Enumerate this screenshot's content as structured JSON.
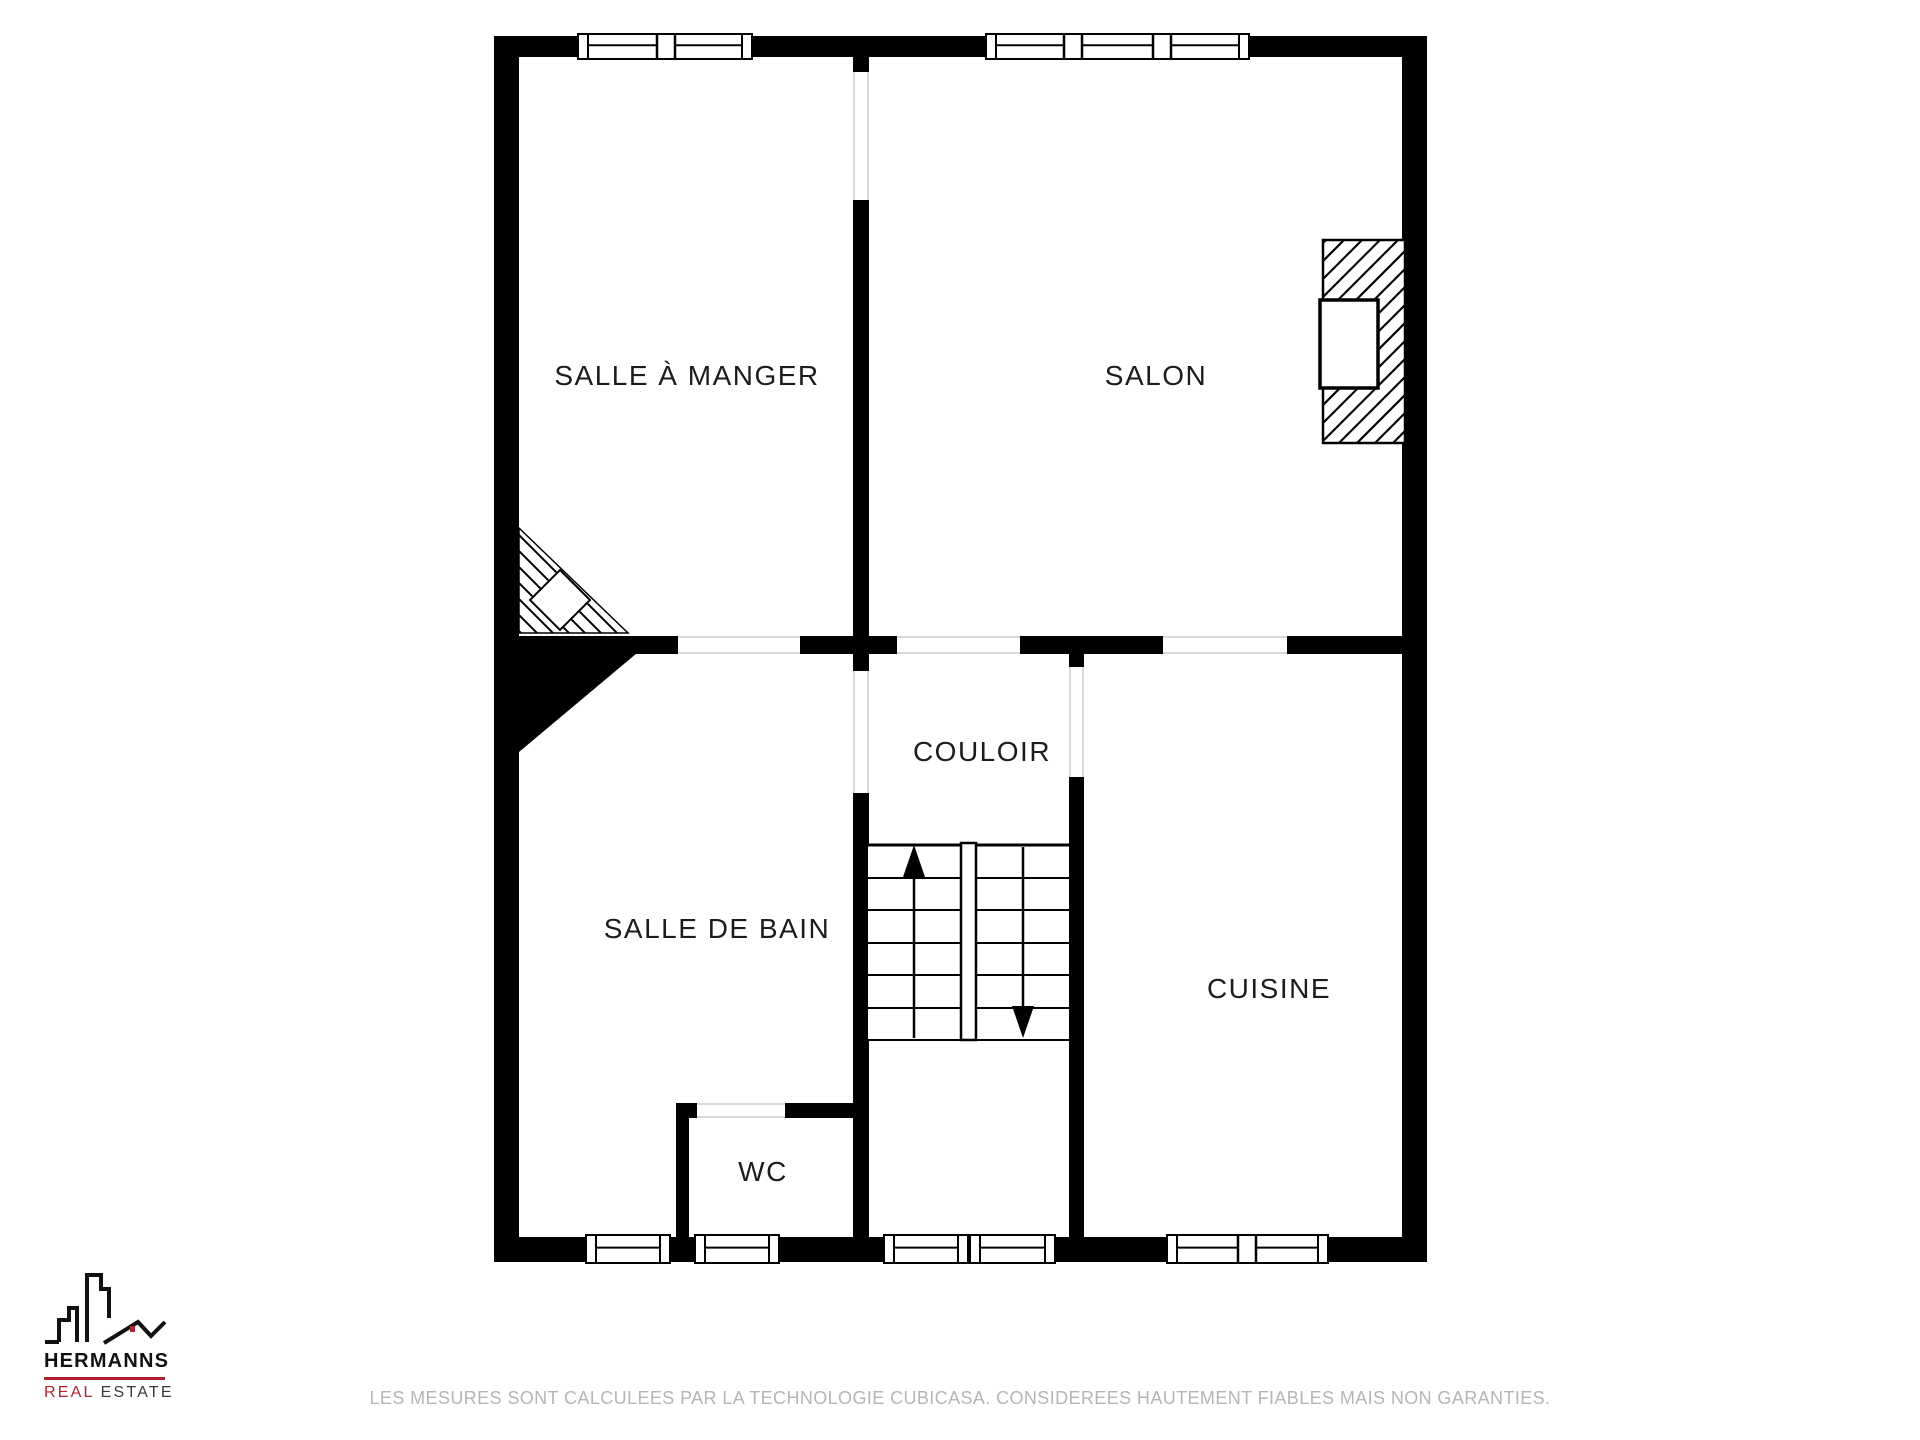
{
  "page": {
    "width": 1920,
    "height": 1440,
    "background": "#ffffff"
  },
  "plan": {
    "colors": {
      "wall": "#000000",
      "room_fill": "#ffffff",
      "door_line": "#d9d9d9",
      "label": "#1c1c1c"
    },
    "rooms": [
      {
        "id": "salle-a-manger",
        "label": "SALLE À MANGER",
        "cx": 687,
        "cy": 376
      },
      {
        "id": "salon",
        "label": "SALON",
        "cx": 1156,
        "cy": 376
      },
      {
        "id": "couloir",
        "label": "COULOIR",
        "cx": 982,
        "cy": 752
      },
      {
        "id": "salle-de-bain",
        "label": "SALLE DE BAIN",
        "cx": 717,
        "cy": 929
      },
      {
        "id": "cuisine",
        "label": "CUISINE",
        "cx": 1269,
        "cy": 989
      },
      {
        "id": "wc",
        "label": "WC",
        "cx": 763,
        "cy": 1172
      }
    ],
    "walls": [
      {
        "x": 494,
        "y": 36,
        "w": 933,
        "h": 21
      },
      {
        "x": 494,
        "y": 1237,
        "w": 933,
        "h": 25
      },
      {
        "x": 494,
        "y": 36,
        "w": 25,
        "h": 1226
      },
      {
        "x": 1402,
        "y": 36,
        "w": 25,
        "h": 1226
      },
      {
        "x": 853,
        "y": 57,
        "w": 16,
        "h": 15
      },
      {
        "x": 853,
        "y": 200,
        "w": 16,
        "h": 454
      },
      {
        "x": 519,
        "y": 636,
        "w": 159,
        "h": 18
      },
      {
        "x": 800,
        "y": 636,
        "w": 97,
        "h": 18
      },
      {
        "x": 1020,
        "y": 636,
        "w": 143,
        "h": 18
      },
      {
        "x": 1287,
        "y": 636,
        "w": 115,
        "h": 18
      },
      {
        "x": 853,
        "y": 654,
        "w": 16,
        "h": 17
      },
      {
        "x": 853,
        "y": 793,
        "w": 16,
        "h": 444
      },
      {
        "x": 1069,
        "y": 654,
        "w": 15,
        "h": 13
      },
      {
        "x": 1069,
        "y": 777,
        "w": 15,
        "h": 460
      },
      {
        "x": 676,
        "y": 1103,
        "w": 21,
        "h": 15
      },
      {
        "x": 785,
        "y": 1103,
        "w": 84,
        "h": 15
      },
      {
        "x": 676,
        "y": 1103,
        "w": 13,
        "h": 134
      }
    ],
    "door_openings": [
      {
        "x": 853,
        "y": 72,
        "w": 16,
        "h": 128,
        "dir": "v"
      },
      {
        "x": 678,
        "y": 636,
        "w": 122,
        "h": 18,
        "dir": "h"
      },
      {
        "x": 897,
        "y": 636,
        "w": 123,
        "h": 18,
        "dir": "h"
      },
      {
        "x": 1163,
        "y": 636,
        "w": 124,
        "h": 18,
        "dir": "h"
      },
      {
        "x": 853,
        "y": 671,
        "w": 16,
        "h": 122,
        "dir": "v"
      },
      {
        "x": 1069,
        "y": 667,
        "w": 15,
        "h": 110,
        "dir": "v"
      },
      {
        "x": 697,
        "y": 1103,
        "w": 88,
        "h": 15,
        "dir": "h"
      }
    ],
    "windows": [
      {
        "x": 578,
        "y": 34,
        "w": 174,
        "h": 25,
        "splits": [
          666
        ]
      },
      {
        "x": 986,
        "y": 34,
        "w": 263,
        "h": 25,
        "splits": [
          1073,
          1162
        ]
      },
      {
        "x": 586,
        "y": 1235,
        "w": 84,
        "h": 28,
        "splits": []
      },
      {
        "x": 695,
        "y": 1235,
        "w": 84,
        "h": 28,
        "splits": []
      },
      {
        "x": 884,
        "y": 1235,
        "w": 84,
        "h": 28,
        "splits": []
      },
      {
        "x": 970,
        "y": 1235,
        "w": 85,
        "h": 28,
        "splits": []
      },
      {
        "x": 1167,
        "y": 1235,
        "w": 161,
        "h": 28,
        "splits": [
          1247
        ]
      }
    ],
    "stairs": {
      "x": 868,
      "y": 845,
      "w": 201,
      "h": 195,
      "tread_ys": [
        878,
        910,
        943,
        975,
        1008
      ],
      "divider": {
        "x": 961,
        "y": 843,
        "w": 15,
        "h": 197
      },
      "arrow_up": {
        "x": 914,
        "tip_y": 845,
        "tail_y": 1038
      },
      "arrow_down": {
        "x": 1023,
        "tip_y": 1038,
        "tail_y": 847
      }
    },
    "fireplace": {
      "x": 1323,
      "y": 240,
      "w": 82,
      "h": 203,
      "notch": {
        "x": 1320,
        "y": 300,
        "w": 58,
        "h": 88
      }
    },
    "winder": {
      "points": "519,528 628,633 519,633",
      "diamond": {
        "cx": 560,
        "cy": 600,
        "r": 30
      }
    },
    "understair": {
      "points": "519,648 643,648 519,752"
    }
  },
  "logo": {
    "brand": "HERMANNS",
    "sub_primary": "REAL",
    "sub_secondary": "ESTATE",
    "accent": "#b0232e",
    "ink": "#111111"
  },
  "footer": {
    "disclaimer": "LES MESURES SONT CALCULEES PAR LA TECHNOLOGIE CUBICASA. CONSIDEREES HAUTEMENT FIABLES MAIS NON GARANTIES."
  }
}
